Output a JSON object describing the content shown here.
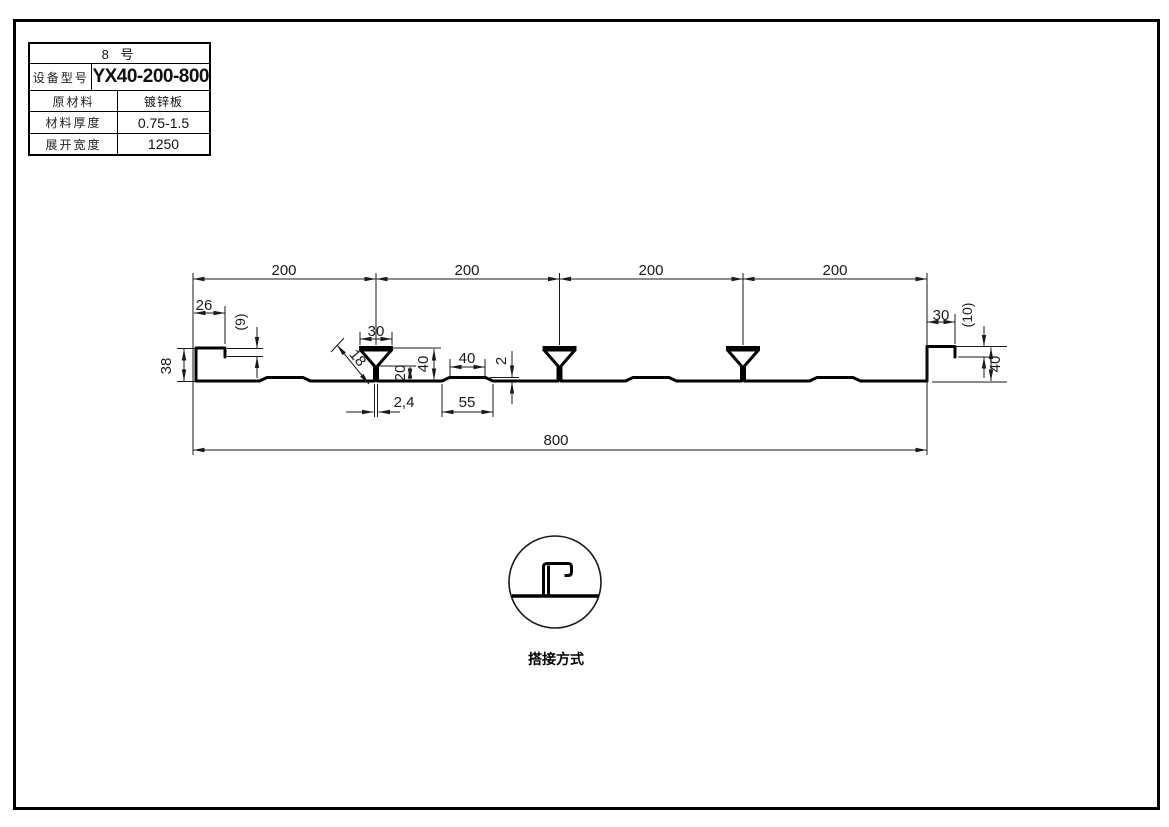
{
  "page": {
    "background": "#ffffff",
    "line_color": "#000000"
  },
  "title_block": {
    "sheet_no": "8 号",
    "rows": [
      {
        "label": "设备型号",
        "value": "YX40-200-800"
      },
      {
        "label": "原材料",
        "value": "镀锌板"
      },
      {
        "label": "材料厚度",
        "value": "0.75-1.5"
      },
      {
        "label": "展开宽度",
        "value": "1250"
      }
    ]
  },
  "drawing": {
    "dims": {
      "span1": "200",
      "span2": "200",
      "span3": "200",
      "span4": "200",
      "total_width": "800",
      "left_top_width": "26",
      "left_lip_height": "(9)",
      "left_edge_height": "38",
      "rib_top_width": "30",
      "rib_slant_length": "18",
      "rib_throat_height": "20",
      "rib_height": "40",
      "stiffener_top_width": "40",
      "stiffener_height": "2",
      "rib_stem_width": "2,4",
      "stiffener_base_width": "55",
      "right_top_width": "30",
      "right_lip_height": "(10)",
      "right_edge_height": "40"
    },
    "lap_detail_label": "搭接方式"
  }
}
